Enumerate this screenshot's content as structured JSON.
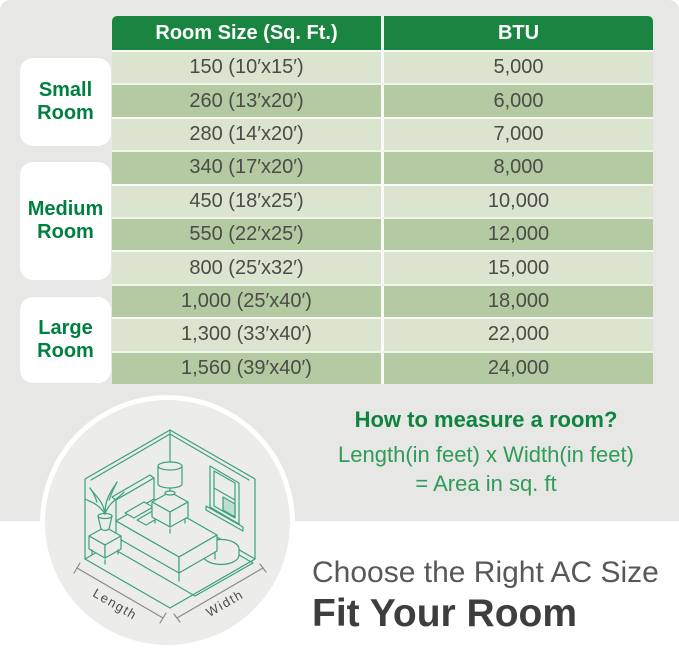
{
  "chart_data": {
    "type": "table",
    "title": "Fit Your Room",
    "subtitle": "Choose the Right AC Size",
    "columns": [
      "Room Size (Sq. Ft.)",
      "BTU"
    ],
    "rows": [
      [
        "150 (10′x15′)",
        "5,000"
      ],
      [
        "260 (13′x20′)",
        "6,000"
      ],
      [
        "280 (14′x20′)",
        "7,000"
      ],
      [
        "340 (17′x20′)",
        "8,000"
      ],
      [
        "450 (18′x25′)",
        "10,000"
      ],
      [
        "550 (22′x25′)",
        "12,000"
      ],
      [
        "800 (25′x32′)",
        "15,000"
      ],
      [
        "1,000 (25′x40′)",
        "18,000"
      ],
      [
        "1,300 (33′x40′)",
        "22,000"
      ],
      [
        "1,560 (39′x40′)",
        "24,000"
      ]
    ],
    "room_area_sqft": [
      150,
      260,
      280,
      340,
      450,
      550,
      800,
      1000,
      1300,
      1560
    ],
    "btu_values": [
      5000,
      6000,
      7000,
      8000,
      10000,
      12000,
      15000,
      18000,
      22000,
      24000
    ],
    "row_groups": [
      {
        "label": "Small Room",
        "row_indices": [
          0,
          1,
          2
        ]
      },
      {
        "label": "Medium Room",
        "row_indices": [
          3,
          4,
          5,
          6
        ]
      },
      {
        "label": "Large Room",
        "row_indices": [
          7,
          8,
          9
        ]
      }
    ],
    "annotation": "How to measure a room? Length(in feet) x Width(in feet) = Area in sq. ft"
  },
  "groups": [
    {
      "line1": "Small",
      "line2": "Room"
    },
    {
      "line1": "Medium",
      "line2": "Room"
    },
    {
      "line1": "Large",
      "line2": "Room"
    }
  ],
  "measure": {
    "title": "How to measure a room?",
    "line1": "Length(in feet) x Width(in feet)",
    "line2": "= Area in sq. ft"
  },
  "illustration": {
    "length_label": "Length",
    "width_label": "Width"
  },
  "footer": {
    "subtitle": "Choose the Right AC Size",
    "title": "Fit Your Room"
  },
  "colors": {
    "header_green": "#1a8540",
    "row_light": "#dbe4ce",
    "row_dark": "#b4caa2",
    "label_green": "#008040",
    "measure_title_green": "#0f8440",
    "measure_green": "#2f9c58",
    "line_teal": "#3aa27c",
    "footer_gray": "#57585a",
    "footer_dark": "#3e3e40",
    "panel_gray": "#e7e7e5",
    "circle_gray": "#ececea"
  }
}
